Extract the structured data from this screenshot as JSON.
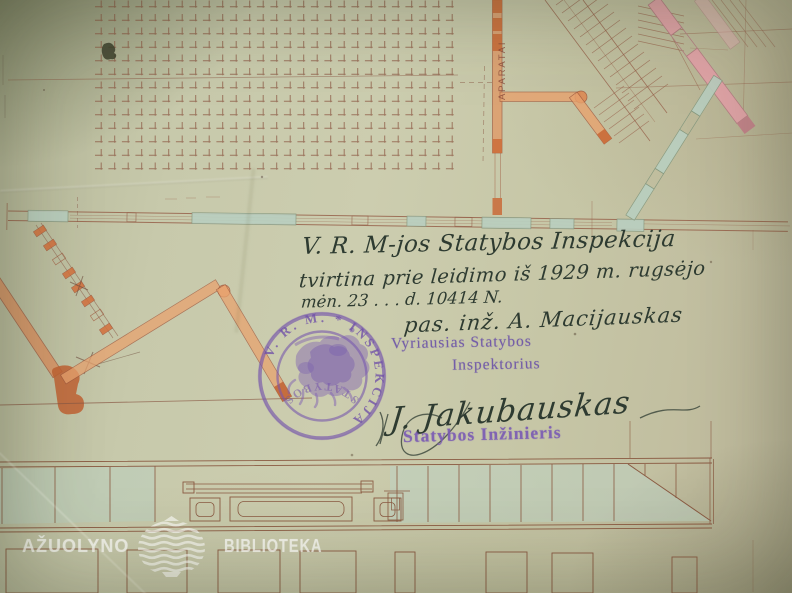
{
  "photo": {
    "description": "Aged architectural floor plan and facade drawing with 1929 approval inscriptions, signatures and stamps"
  },
  "handwriting": {
    "line1": "V. R. M-jos Statybos Inspekcija",
    "line2": "tvirtina prie leidimo iš 1929 m. rugsėjo",
    "line3": "mėn. 23 . . . d. 10414 N.",
    "line4": "pas. inž. A. Macijauskas",
    "signature": "J. Jakubauskas"
  },
  "stamps": {
    "seal_arc_text": "V. R. M.  *  INSPEKCIJA",
    "seal_bottom_text": "STATYBOS",
    "chief_inspector_line1": "Vyriausias Statybos",
    "chief_inspector_line2": "Inspektorius",
    "engineer": "Statybos Inžinieris"
  },
  "plan": {
    "room_label_vertical": "APARATAI"
  },
  "watermark": {
    "left_word": "AŽUOLYNO",
    "right_word": "BIBLIOTEKA"
  },
  "colors": {
    "paper": "#c6c8a9",
    "ink": "#2e3b31",
    "stamp_purple": "#7757ab",
    "wall_orange": "#dd8b55",
    "wall_pink": "#dfa3a6",
    "wall_green": "#b9cfc0",
    "line_brown": "#96604a"
  }
}
